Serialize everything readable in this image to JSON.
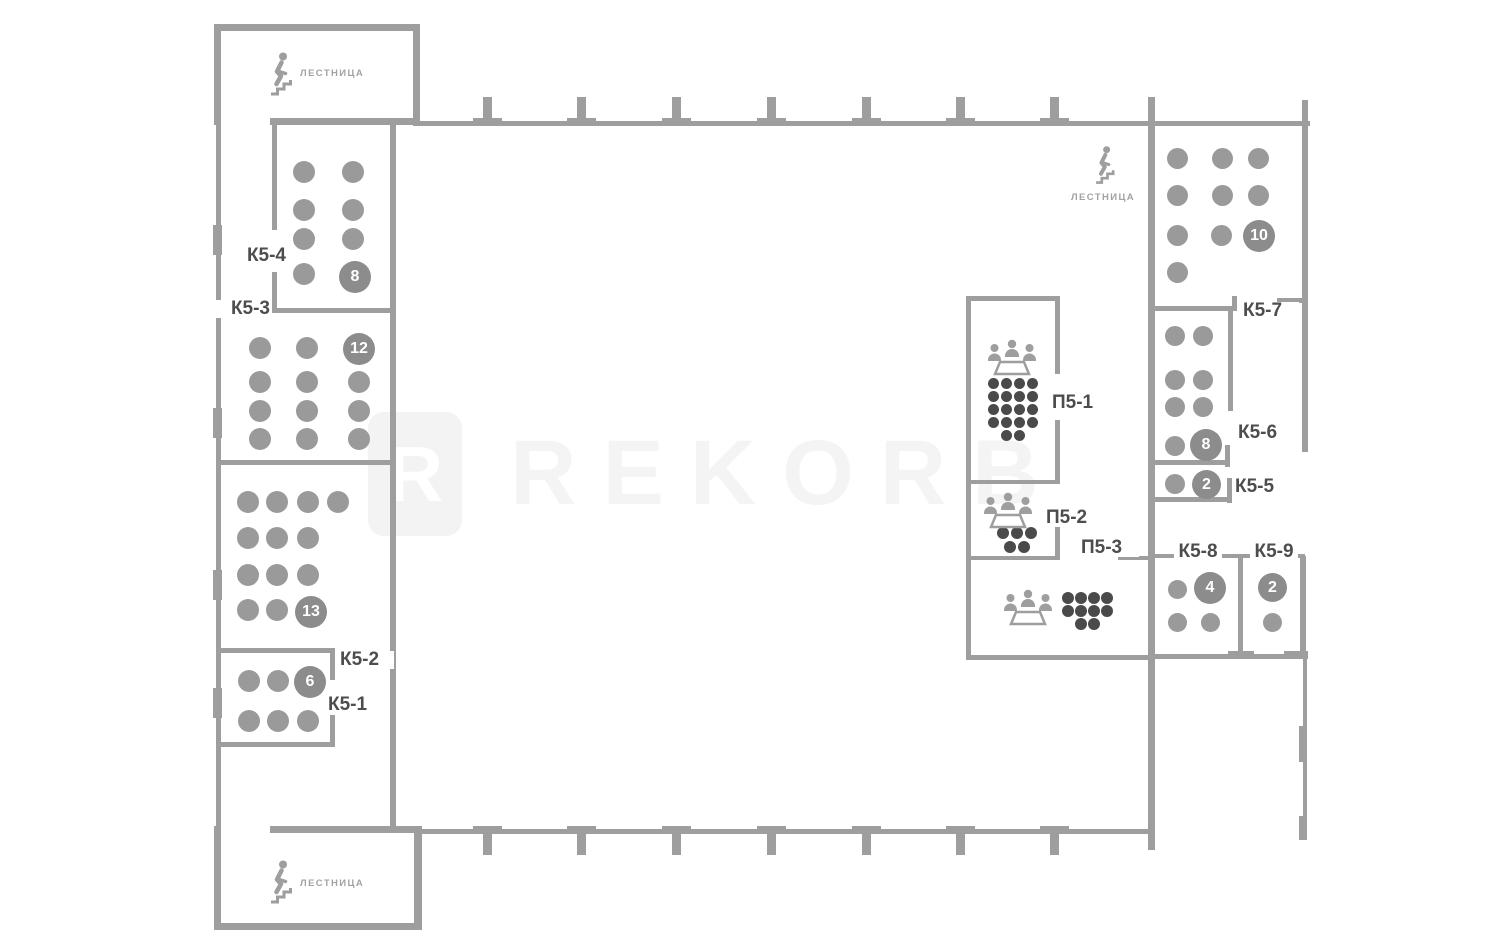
{
  "watermark": {
    "logo_letter": "R",
    "text": "REKORB"
  },
  "stairwells": {
    "top_left": {
      "label": "ЛЕСТНИЦА"
    },
    "top_right": {
      "label": "ЛЕСТНИЦА"
    },
    "bottom_left": {
      "label": "ЛЕСТНИЦА"
    }
  },
  "colors": {
    "wall": "#9e9e9e",
    "workstation_dot": "#9a9a9a",
    "meeting_dot": "#4a4a4a",
    "badge": "#8c8c8c",
    "label": "#4d4d4d",
    "watermark": "#f4f4f4"
  },
  "rooms": {
    "k5_1": {
      "label": "К5-1",
      "capacity": "6",
      "seat_style": "desk",
      "seat_d": 22,
      "seats": [
        [
          249,
          681
        ],
        [
          278,
          681
        ],
        [
          249,
          721
        ],
        [
          278,
          721
        ],
        [
          308,
          721
        ]
      ]
    },
    "k5_2": {
      "label": "К5-2",
      "capacity": "13",
      "seat_style": "desk",
      "seat_d": 22,
      "seats": [
        [
          248,
          502
        ],
        [
          277,
          502
        ],
        [
          308,
          502
        ],
        [
          338,
          502
        ],
        [
          248,
          538
        ],
        [
          277,
          538
        ],
        [
          308,
          538
        ],
        [
          248,
          575
        ],
        [
          277,
          575
        ],
        [
          308,
          575
        ],
        [
          248,
          610
        ],
        [
          277,
          610
        ]
      ]
    },
    "k5_3": {
      "label": "К5-3",
      "capacity": "12",
      "seat_style": "desk",
      "seat_d": 22,
      "seats": [
        [
          260,
          348
        ],
        [
          307,
          348
        ],
        [
          260,
          382
        ],
        [
          307,
          382
        ],
        [
          359,
          382
        ],
        [
          260,
          411
        ],
        [
          307,
          411
        ],
        [
          359,
          411
        ],
        [
          260,
          439
        ],
        [
          307,
          439
        ],
        [
          359,
          439
        ]
      ]
    },
    "k5_4": {
      "label": "К5-4",
      "capacity": "8",
      "seat_style": "desk",
      "seat_d": 22,
      "seats": [
        [
          304,
          172
        ],
        [
          353,
          172
        ],
        [
          304,
          210
        ],
        [
          353,
          210
        ],
        [
          304,
          239
        ],
        [
          353,
          239
        ],
        [
          304,
          274
        ]
      ]
    },
    "k5_5": {
      "label": "К5-5",
      "capacity": "2",
      "seat_style": "desk",
      "seat_d": 20,
      "seats": [
        [
          1175,
          484
        ]
      ]
    },
    "k5_6": {
      "label": "К5-6",
      "capacity": "8",
      "seat_style": "desk",
      "seat_d": 20,
      "seats": [
        [
          1175,
          336
        ],
        [
          1203,
          336
        ],
        [
          1175,
          380
        ],
        [
          1203,
          380
        ],
        [
          1175,
          407
        ],
        [
          1203,
          407
        ],
        [
          1175,
          446
        ]
      ]
    },
    "k5_7": {
      "label": "К5-7",
      "capacity": "10",
      "seat_style": "desk",
      "seat_d": 21,
      "seats": [
        [
          1177,
          158
        ],
        [
          1222,
          158
        ],
        [
          1258,
          158
        ],
        [
          1177,
          195
        ],
        [
          1222,
          195
        ],
        [
          1258,
          195
        ],
        [
          1177,
          235
        ],
        [
          1221,
          235
        ],
        [
          1177,
          272
        ]
      ]
    },
    "k5_8": {
      "label": "К5-8",
      "capacity": "4",
      "seat_style": "desk",
      "seat_d": 19,
      "seats": [
        [
          1177,
          589
        ],
        [
          1177,
          622
        ],
        [
          1210,
          622
        ]
      ]
    },
    "k5_9": {
      "label": "К5-9",
      "capacity": "2",
      "seat_style": "desk",
      "seat_d": 19,
      "seats": [
        [
          1272,
          622
        ]
      ]
    },
    "p5_1": {
      "label": "П5-1",
      "seat_style": "meeting",
      "seat_d": 11,
      "seats": [
        [
          993,
          383
        ],
        [
          1006,
          383
        ],
        [
          1019,
          383
        ],
        [
          1032,
          383
        ],
        [
          993,
          396
        ],
        [
          1006,
          396
        ],
        [
          1019,
          396
        ],
        [
          1032,
          396
        ],
        [
          993,
          409
        ],
        [
          1006,
          409
        ],
        [
          1019,
          409
        ],
        [
          1032,
          409
        ],
        [
          993,
          422
        ],
        [
          1006,
          422
        ],
        [
          1019,
          422
        ],
        [
          1032,
          422
        ],
        [
          1006,
          435
        ],
        [
          1019,
          435
        ]
      ]
    },
    "p5_2": {
      "label": "П5-2",
      "seat_style": "meeting",
      "seat_d": 12,
      "seats": [
        [
          1003,
          533
        ],
        [
          1017,
          533
        ],
        [
          1031,
          533
        ],
        [
          1010,
          547
        ],
        [
          1024,
          547
        ]
      ]
    },
    "p5_3": {
      "label": "П5-3",
      "seat_style": "meeting",
      "seat_d": 12,
      "seats": [
        [
          1068,
          598
        ],
        [
          1081,
          598
        ],
        [
          1094,
          598
        ],
        [
          1107,
          598
        ],
        [
          1068,
          611
        ],
        [
          1081,
          611
        ],
        [
          1094,
          611
        ],
        [
          1107,
          611
        ],
        [
          1081,
          624
        ],
        [
          1094,
          624
        ]
      ]
    }
  }
}
